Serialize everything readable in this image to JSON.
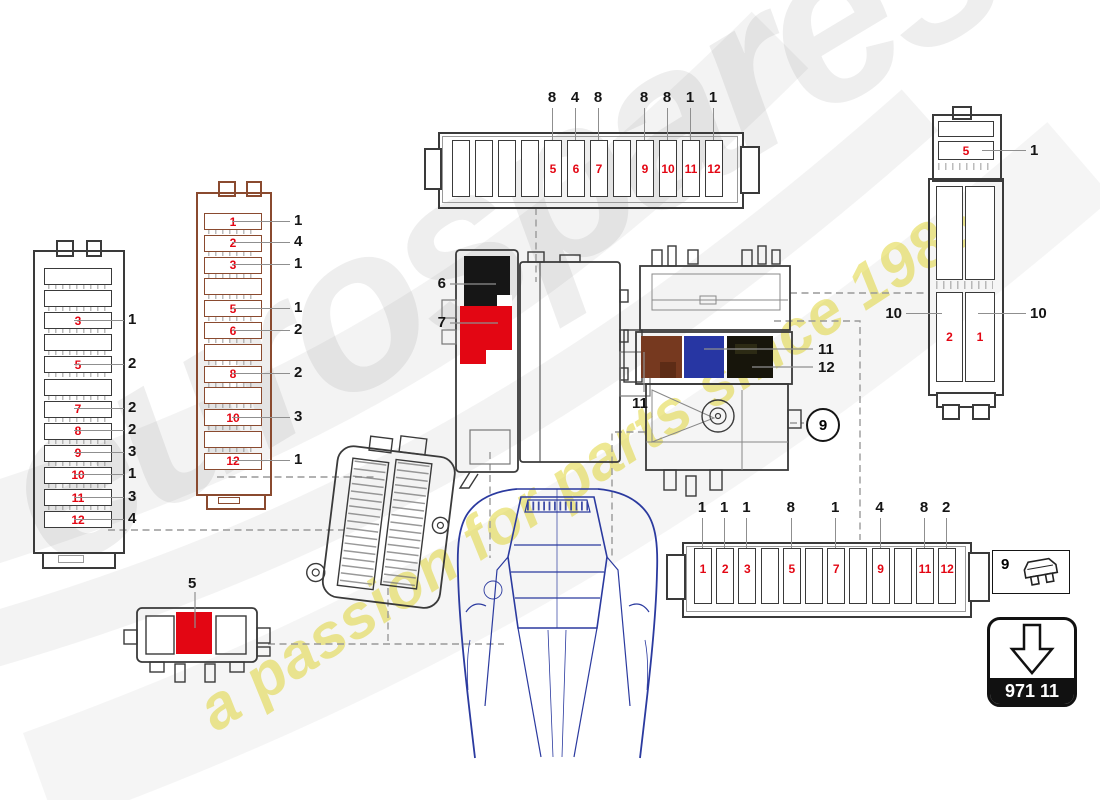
{
  "watermark": {
    "brand": "eurospares",
    "tagline": "a passion for parts since 1985"
  },
  "colors": {
    "red": "#e30613",
    "brown": "#8a4a2f",
    "relay_black": "#161616",
    "relay_brown": "#76391f",
    "relay_blue": "#2736a3",
    "relay_dark": "#17150b",
    "line": "#3a3a3a",
    "leader": "#8f8f8f",
    "car_blue": "#2b3a9f",
    "watermark_yellow": "#ded228"
  },
  "boxes": {
    "left": {
      "rows": 12,
      "red_labels": {
        "3": "3",
        "5": "5",
        "7": "7",
        "8": "8",
        "9": "9",
        "10": "10",
        "11": "11",
        "12": "12"
      },
      "callouts": {
        "3": "1",
        "5": "2",
        "7": "2",
        "8": "2",
        "9": "3",
        "10": "1",
        "11": "3",
        "12": "4"
      }
    },
    "brown": {
      "rows": 12,
      "red_labels": {
        "1": "1",
        "2": "2",
        "3": "3",
        "5": "5",
        "6": "6",
        "8": "8",
        "10": "10",
        "12": "12"
      },
      "callouts": {
        "1": "1",
        "2": "4",
        "3": "1",
        "5": "1",
        "6": "2",
        "8": "2",
        "10": "3",
        "12": "1"
      }
    }
  },
  "strips": {
    "top": {
      "slots": 12,
      "red_labels": {
        "5": "5",
        "6": "6",
        "7": "7",
        "9": "9",
        "10": "10",
        "11": "11",
        "12": "12"
      },
      "callouts": {
        "5": "8",
        "6": "4",
        "7": "8",
        "9": "8",
        "10": "8",
        "11": "1",
        "12": "1"
      }
    },
    "bottom": {
      "slots": 12,
      "red_labels": {
        "1": "1",
        "2": "2",
        "3": "3",
        "5": "5",
        "7": "7",
        "9": "9",
        "11": "11",
        "12": "12"
      },
      "callouts": {
        "1": "1",
        "2": "1",
        "3": "1",
        "5": "8",
        "7": "1",
        "9": "4",
        "11": "8",
        "12": "2"
      }
    }
  },
  "relay_carrier": {
    "black_callout": "6",
    "red_callout": "7"
  },
  "relay_assembly": {
    "brown_callout": "11",
    "blue_callout": "11",
    "dark_callout": "12"
  },
  "holder_right": {
    "top_red": "5",
    "top_callout": "1",
    "bottom_left_red": "2",
    "bottom_right_red": "1",
    "left_callout": "10",
    "right_callout": "10"
  },
  "small_relay": {
    "callout": "5"
  },
  "callout_circle": {
    "number": "9"
  },
  "legend": {
    "number": "9",
    "icon": "blade-fuse-icon"
  },
  "part_box": {
    "code": "971 11",
    "icon": "down-arrow-icon"
  }
}
